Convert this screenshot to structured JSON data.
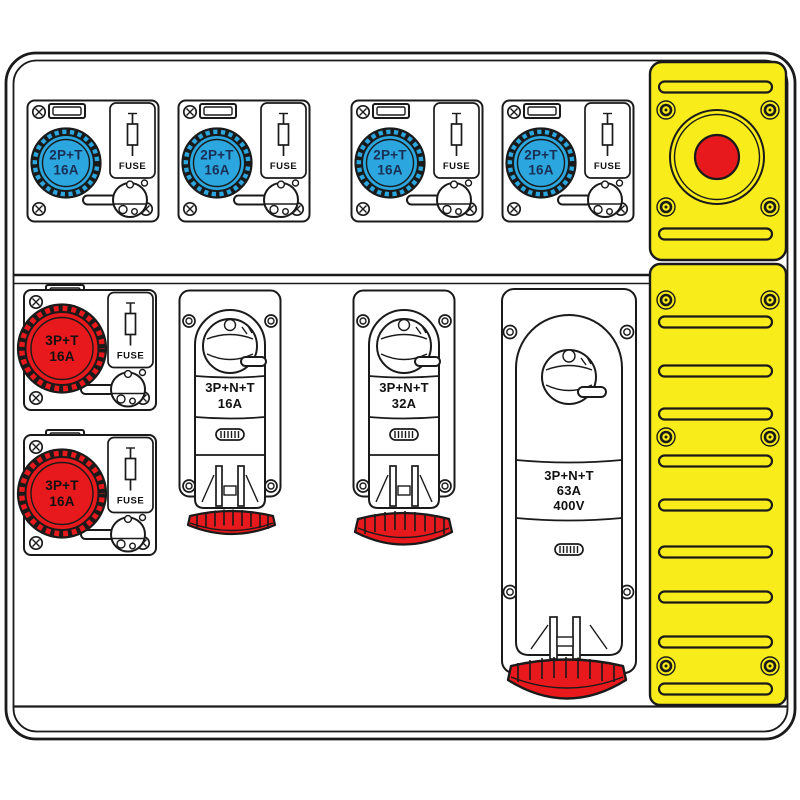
{
  "colors": {
    "panel_yellow": "#f8ec1a",
    "cee_blue": "#2ba6de",
    "cee_red": "#e8191c",
    "line_art": "#1a1a1a",
    "label_on_blue": "#1a2f55"
  },
  "icons": {
    "emergency_stop": "emergency-stop-button",
    "fuse": "fuse-symbol",
    "screw": "screw-head"
  },
  "top_row_units": [
    {
      "label": "2P+T",
      "rating": "16A",
      "fuse_label": "FUSE"
    },
    {
      "label": "2P+T",
      "rating": "16A",
      "fuse_label": "FUSE"
    },
    {
      "label": "2P+T",
      "rating": "16A",
      "fuse_label": "FUSE"
    },
    {
      "label": "2P+T",
      "rating": "16A",
      "fuse_label": "FUSE"
    }
  ],
  "left_column_units": [
    {
      "label": "3P+T",
      "rating": "16A",
      "fuse_label": "FUSE"
    },
    {
      "label": "3P+T",
      "rating": "16A",
      "fuse_label": "FUSE"
    }
  ],
  "vertical_units": [
    {
      "label": "3P+N+T",
      "rating": "16A"
    },
    {
      "label": "3P+N+T",
      "rating": "32A"
    },
    {
      "label": "3P+N+T",
      "rating": "63A",
      "voltage": "400V"
    }
  ]
}
